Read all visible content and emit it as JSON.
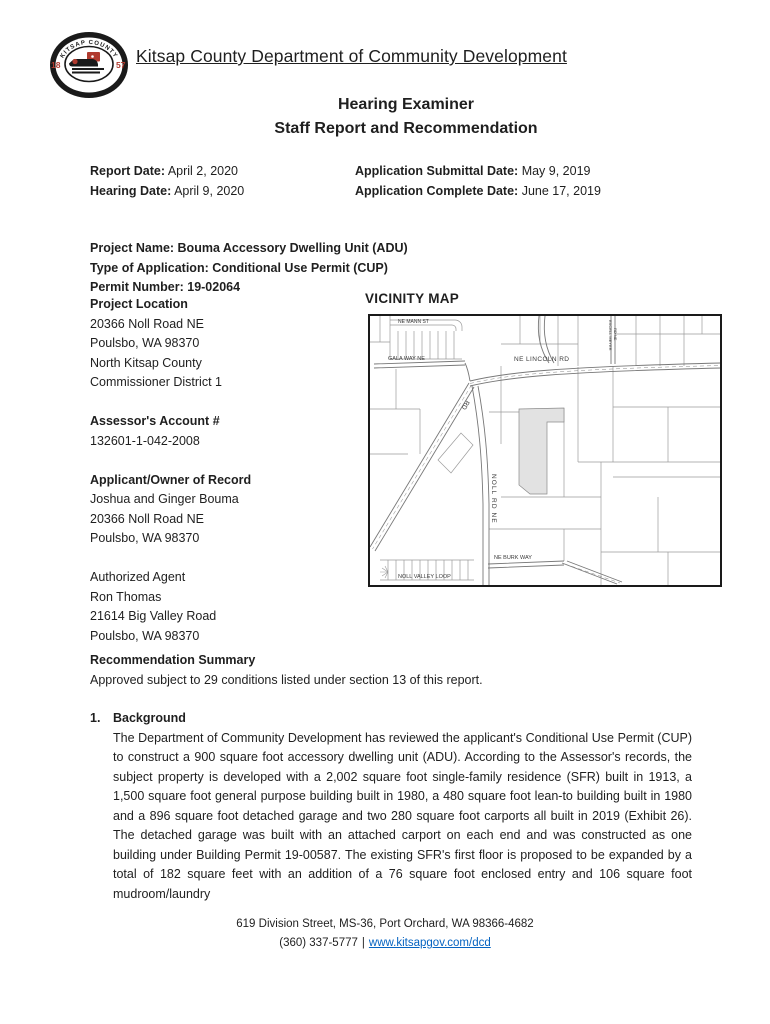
{
  "header": {
    "department_title": "Kitsap County Department of Community Development",
    "report_title_line1": "Hearing Examiner",
    "report_title_line2": "Staff Report and Recommendation",
    "seal": {
      "top_text": "KITSAP COUNTY",
      "bottom_text": "WASHINGTON",
      "year_left": "18",
      "year_right": "57",
      "accent_color": "#b03a2e",
      "ring_color": "#1a1a1a"
    }
  },
  "dates": {
    "report_date_label": "Report Date:",
    "report_date_value": "April 2, 2020",
    "hearing_date_label": "Hearing Date:",
    "hearing_date_value": "April 9, 2020",
    "submittal_date_label": "Application Submittal Date:",
    "submittal_date_value": "May 9, 2019",
    "complete_date_label": "Application Complete Date:",
    "complete_date_value": "June 17, 2019"
  },
  "project": {
    "name_line": "Project Name: Bouma Accessory Dwelling Unit (ADU)",
    "type_line": "Type of Application: Conditional Use Permit (CUP)",
    "permit_line": "Permit Number: 19-02064"
  },
  "info": {
    "location": {
      "heading": "Project Location",
      "lines": [
        "20366 Noll Road NE",
        "Poulsbo, WA 98370",
        "North Kitsap County",
        "Commissioner District 1"
      ]
    },
    "assessor": {
      "heading": "Assessor's Account #",
      "lines": [
        "132601-1-042-2008"
      ]
    },
    "applicant": {
      "heading": "Applicant/Owner of Record",
      "lines": [
        "Joshua and Ginger Bouma",
        "20366 Noll Road NE",
        "Poulsbo, WA 98370"
      ]
    },
    "agent": {
      "heading": "Authorized Agent",
      "lines": [
        "Ron Thomas",
        "21614 Big Valley Road",
        "Poulsbo, WA 98370"
      ]
    }
  },
  "map": {
    "title": "VICINITY MAP",
    "highlight_parcel_color": "#e2e2e2",
    "street_labels": {
      "mann": "NE MANN ST",
      "gala": "GALA WAY NE",
      "lincoln": "NE LINCOLN RD",
      "rd": "RD",
      "noll": "NOLL RD NE",
      "excell_meyer_line1": "EXCELL MEYER",
      "excell_meyer_line2": "RD NE",
      "burk": "NE BURK WAY",
      "noll_valley": "NOLL VALLEY LOOP"
    }
  },
  "recommendation": {
    "heading": "Recommendation Summary",
    "body": "Approved subject to 29 conditions listed under section 13 of this report."
  },
  "background": {
    "number": "1.",
    "heading": "Background",
    "paragraph": "The Department of Community Development has reviewed the applicant's Conditional Use Permit (CUP) to construct a 900 square foot accessory dwelling unit (ADU). According to the Assessor's records, the subject property is developed with a 2,002 square foot single-family residence (SFR) built in 1913, a 1,500 square foot general purpose building built in 1980, a 480 square foot lean-to building built in 1980 and a 896 square foot detached garage and two 280 square foot carports all built in 2019 (Exhibit 26). The detached garage was built with an attached carport on each end and was constructed as one building under Building Permit 19-00587. The existing SFR's first floor is proposed to be expanded by a total of 182 square feet with an addition of a 76 square foot enclosed entry and 106 square foot mudroom/laundry"
  },
  "footer": {
    "address": "619 Division Street, MS-36, Port Orchard, WA 98366-4682",
    "phone": "(360) 337-5777",
    "separator": "|",
    "link": "www.kitsapgov.com/dcd",
    "link_color": "#0563c1"
  }
}
